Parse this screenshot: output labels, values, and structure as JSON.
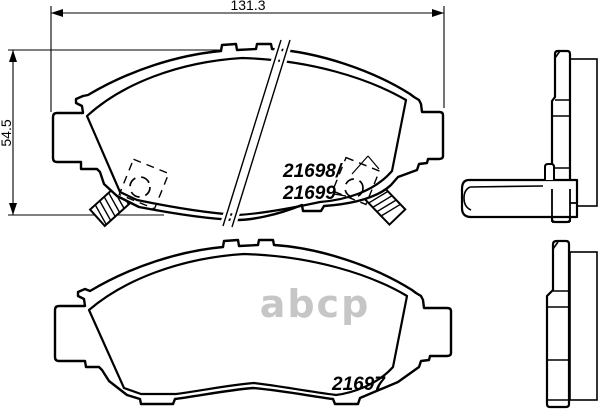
{
  "drawing": {
    "background_color": "#ffffff",
    "line_color": "#000000",
    "dimensions": {
      "width_label": "131.3",
      "height_label": "54.5"
    },
    "part_labels": {
      "upper_pad_line1": "21698/",
      "upper_pad_line2": "21699",
      "lower_pad": "21697"
    },
    "watermark": {
      "text": "abcp",
      "color": "#c6c6c6"
    }
  }
}
